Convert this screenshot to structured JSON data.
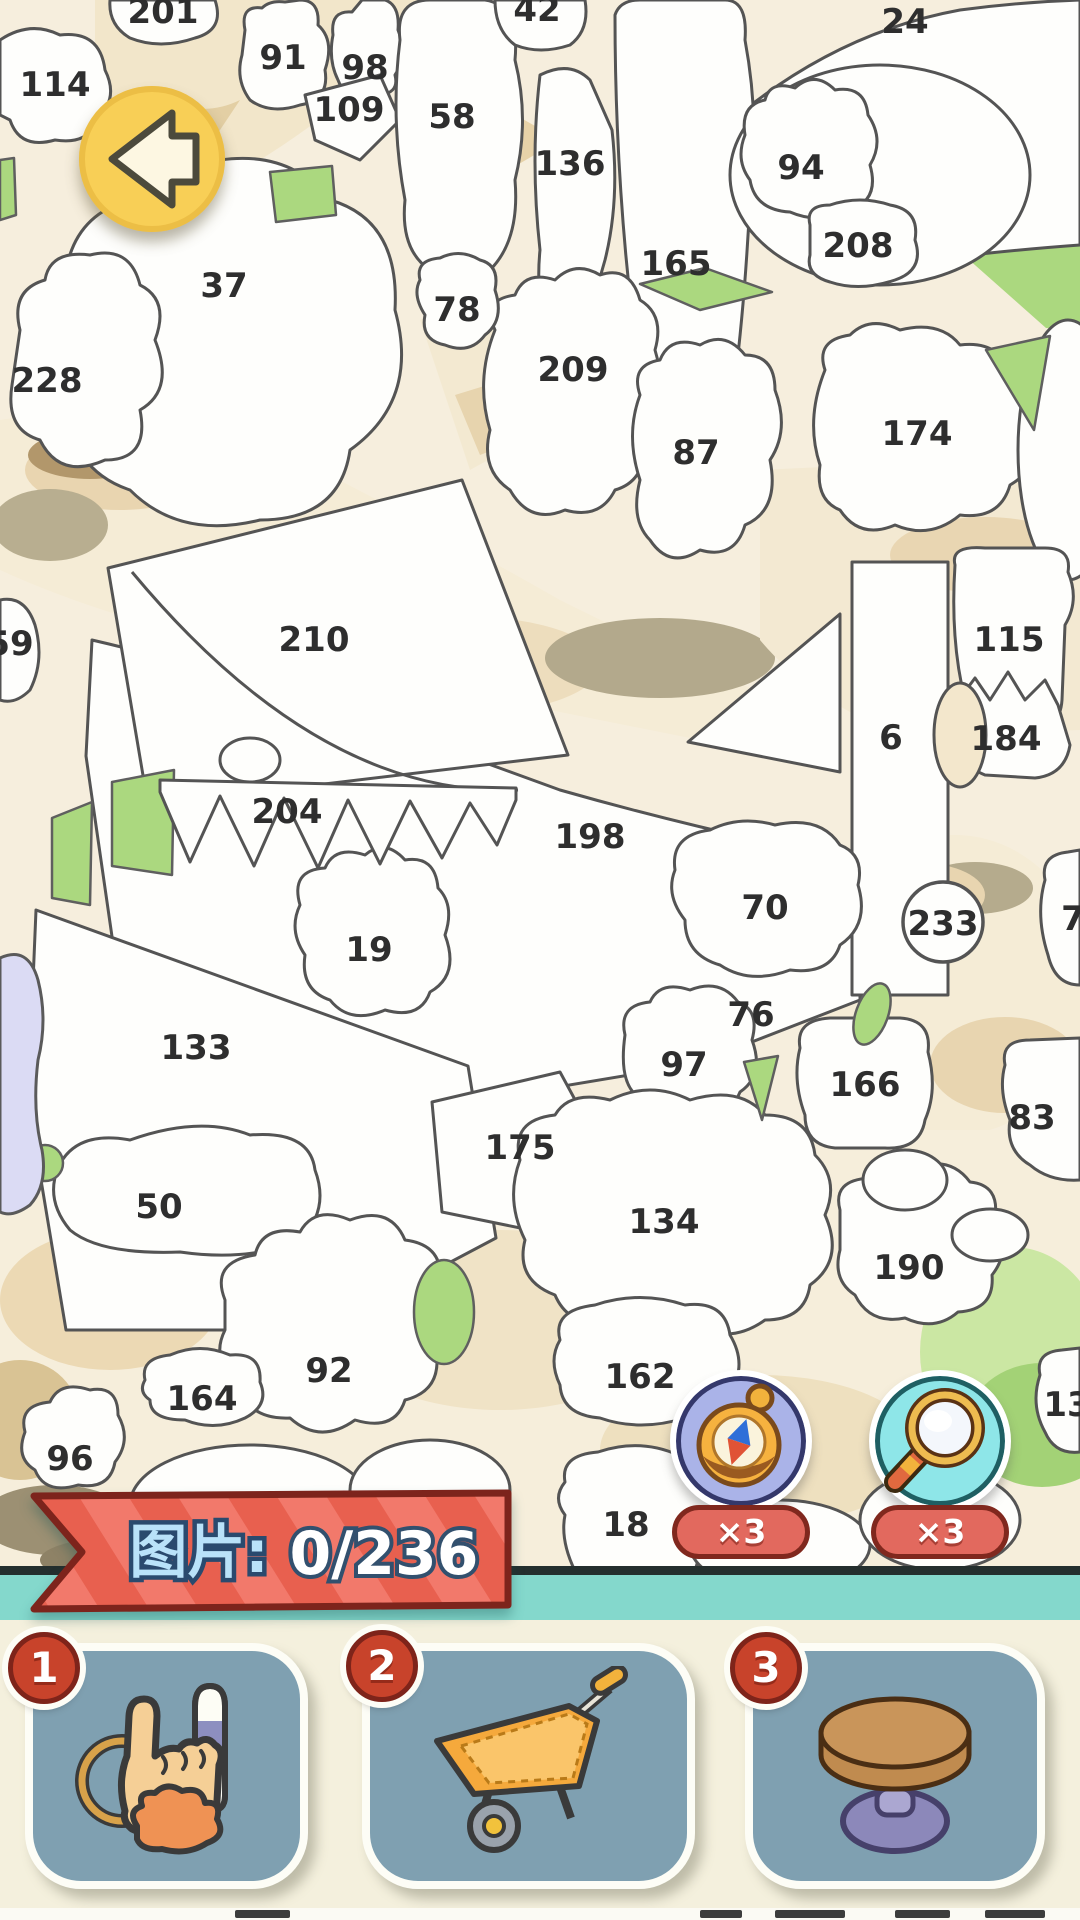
{
  "back_button": {
    "icon": "back-arrow-icon"
  },
  "puzzle": {
    "regions": [
      {
        "n": "201",
        "x": 163,
        "y": 12
      },
      {
        "n": "42",
        "x": 537,
        "y": 10
      },
      {
        "n": "24",
        "x": 905,
        "y": 22
      },
      {
        "n": "91",
        "x": 283,
        "y": 58
      },
      {
        "n": "98",
        "x": 365,
        "y": 68
      },
      {
        "n": "109",
        "x": 349,
        "y": 110
      },
      {
        "n": "114",
        "x": 55,
        "y": 85
      },
      {
        "n": "58",
        "x": 452,
        "y": 117
      },
      {
        "n": "136",
        "x": 570,
        "y": 164
      },
      {
        "n": "94",
        "x": 801,
        "y": 168
      },
      {
        "n": "208",
        "x": 858,
        "y": 246
      },
      {
        "n": "165",
        "x": 676,
        "y": 264
      },
      {
        "n": "37",
        "x": 224,
        "y": 286
      },
      {
        "n": "78",
        "x": 457,
        "y": 310
      },
      {
        "n": "228",
        "x": 47,
        "y": 381
      },
      {
        "n": "209",
        "x": 573,
        "y": 370
      },
      {
        "n": "87",
        "x": 696,
        "y": 453
      },
      {
        "n": "174",
        "x": 917,
        "y": 434
      },
      {
        "n": "210",
        "x": 314,
        "y": 640
      },
      {
        "n": "115",
        "x": 1009,
        "y": 640
      },
      {
        "n": "59",
        "x": 10,
        "y": 644
      },
      {
        "n": "6",
        "x": 891,
        "y": 738
      },
      {
        "n": "184",
        "x": 1006,
        "y": 739
      },
      {
        "n": "204",
        "x": 287,
        "y": 812
      },
      {
        "n": "198",
        "x": 590,
        "y": 837
      },
      {
        "n": "70",
        "x": 765,
        "y": 908
      },
      {
        "n": "233",
        "x": 943,
        "y": 924,
        "circled": true
      },
      {
        "n": "7",
        "x": 1073,
        "y": 919
      },
      {
        "n": "19",
        "x": 369,
        "y": 950
      },
      {
        "n": "76",
        "x": 751,
        "y": 1015
      },
      {
        "n": "133",
        "x": 196,
        "y": 1048
      },
      {
        "n": "97",
        "x": 684,
        "y": 1065
      },
      {
        "n": "166",
        "x": 865,
        "y": 1085
      },
      {
        "n": "83",
        "x": 1032,
        "y": 1118
      },
      {
        "n": "175",
        "x": 520,
        "y": 1148
      },
      {
        "n": "50",
        "x": 159,
        "y": 1207
      },
      {
        "n": "134",
        "x": 664,
        "y": 1222
      },
      {
        "n": "190",
        "x": 909,
        "y": 1268
      },
      {
        "n": "92",
        "x": 329,
        "y": 1371
      },
      {
        "n": "162",
        "x": 640,
        "y": 1377
      },
      {
        "n": "164",
        "x": 202,
        "y": 1399
      },
      {
        "n": "13",
        "x": 1067,
        "y": 1405
      },
      {
        "n": "96",
        "x": 70,
        "y": 1459
      },
      {
        "n": "18",
        "x": 626,
        "y": 1525
      }
    ]
  },
  "boosters": {
    "compass": {
      "icon": "compass-icon",
      "count": "×3"
    },
    "magnifier": {
      "icon": "magnifier-icon",
      "count": "×3"
    }
  },
  "banner": {
    "label": "图片:",
    "progress": "0/236"
  },
  "items": [
    {
      "number": "1",
      "icon": "hand-keychain-icon"
    },
    {
      "number": "2",
      "icon": "wheelbarrow-icon"
    },
    {
      "number": "3",
      "icon": "round-table-icon"
    }
  ],
  "colors": {
    "canvas_cream": "#f6eedd",
    "patch_tan": "#e9d5b0",
    "patch_green": "#abd87f",
    "outline_gray": "#545454",
    "banner_red": "#f2796b",
    "banner_border": "#7d241c",
    "banner_label_blue": "#b9e2f9",
    "teal_strip": "#84d8cc",
    "card_slate": "#7fa0b1",
    "badge_red": "#c8432b",
    "back_yellow": "#f8cf56",
    "compass_purple": "#aab3e8",
    "magnifier_cyan": "#8ee6e8",
    "count_badge_red": "#e2695e"
  }
}
